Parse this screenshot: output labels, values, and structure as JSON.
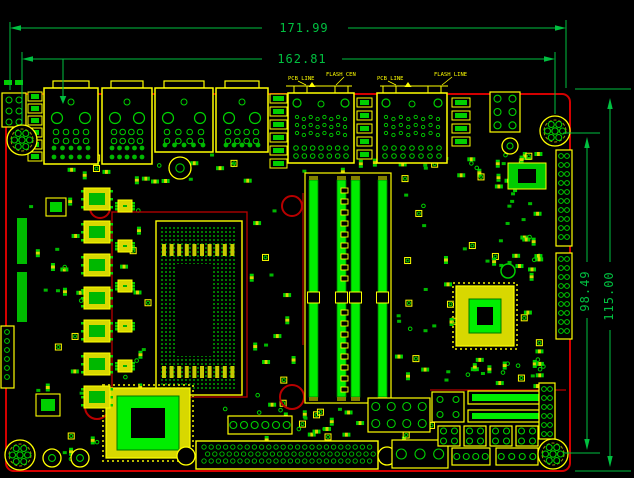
{
  "drawing": {
    "type": "pcb-layout-cad-drawing",
    "dimensions": {
      "board_width": "171.99",
      "mount_hole_span_width": "162.81",
      "board_height": "115.00",
      "mount_hole_span_height": "98.49"
    },
    "callouts": [
      "PCB LINE",
      "FLASH CEN",
      "PCB LINE",
      "FLASH LINE"
    ]
  },
  "colors": {
    "background": "#000000",
    "board_outline": "#d40000",
    "keepout": "#b80000",
    "dimension": "#00c040",
    "component_outline": "#ffff00",
    "component_fill": "#d8d800",
    "pad": "#00d000",
    "copper_bright": "#00ee00"
  }
}
